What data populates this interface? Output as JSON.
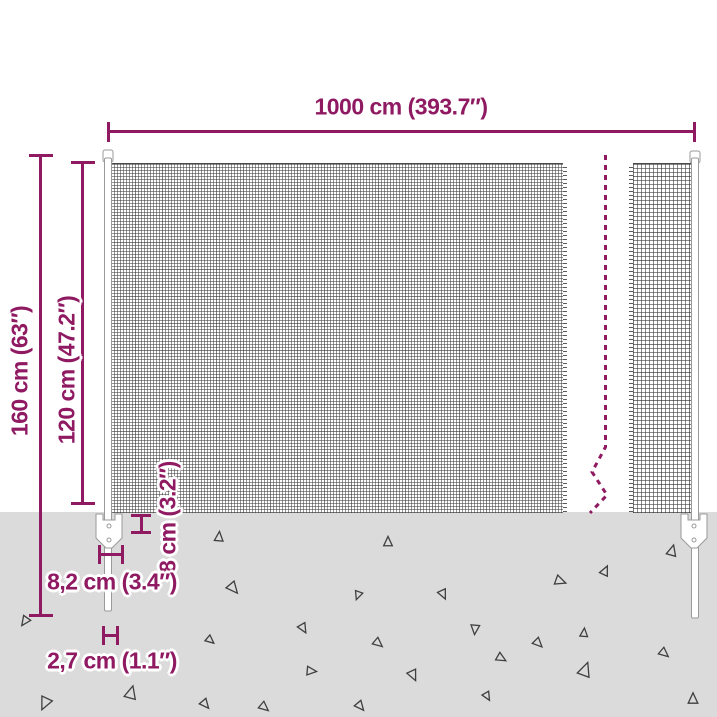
{
  "diagram": {
    "description": "wire-mesh-fence-dimension-diagram",
    "accent_color": "#8f1a62",
    "ground_color": "#dbdbdb",
    "mesh_wire_color": "#3e3e3e",
    "post_fill": "#ffffff",
    "post_outline": "#9a9a9a",
    "triangle_outline": "#3f3f3f",
    "labels": {
      "total_width": "1000 cm (393.7″)",
      "total_height": "160 cm (63″)",
      "fence_height": "120 cm (47.2″)",
      "anchor_plate_height": "8 cm (3.2″)",
      "anchor_plate_width": "8,2 cm (3.4″)",
      "spike_width": "2,7 cm (1.1″)"
    },
    "ground_triangles": [
      {
        "x": 219,
        "y": 537,
        "s": 9,
        "r": 5
      },
      {
        "x": 388,
        "y": 542,
        "s": 9,
        "r": 0
      },
      {
        "x": 672,
        "y": 551,
        "s": 10,
        "r": 15
      },
      {
        "x": 605,
        "y": 571,
        "s": 9,
        "r": 25
      },
      {
        "x": 560,
        "y": 581,
        "s": 10,
        "r": 110
      },
      {
        "x": 233,
        "y": 588,
        "s": 11,
        "r": 140
      },
      {
        "x": 443,
        "y": 594,
        "s": 9,
        "r": 155
      },
      {
        "x": 303,
        "y": 628,
        "s": 9,
        "r": 150
      },
      {
        "x": 475,
        "y": 629,
        "s": 9,
        "r": 185
      },
      {
        "x": 584,
        "y": 633,
        "s": 8,
        "r": 5
      },
      {
        "x": 210,
        "y": 640,
        "s": 8,
        "r": 130
      },
      {
        "x": 25,
        "y": 621,
        "s": 9,
        "r": 215
      },
      {
        "x": 378,
        "y": 643,
        "s": 9,
        "r": 130
      },
      {
        "x": 538,
        "y": 643,
        "s": 9,
        "r": 135
      },
      {
        "x": 311,
        "y": 671,
        "s": 9,
        "r": 95
      },
      {
        "x": 501,
        "y": 658,
        "s": 9,
        "r": 120
      },
      {
        "x": 664,
        "y": 653,
        "s": 9,
        "r": 130
      },
      {
        "x": 413,
        "y": 675,
        "s": 10,
        "r": 155
      },
      {
        "x": 585,
        "y": 670,
        "s": 13,
        "r": 20
      },
      {
        "x": 131,
        "y": 693,
        "s": 12,
        "r": 15
      },
      {
        "x": 45,
        "y": 703,
        "s": 12,
        "r": 205
      },
      {
        "x": 205,
        "y": 704,
        "s": 9,
        "r": 140
      },
      {
        "x": 264,
        "y": 707,
        "s": 9,
        "r": 130
      },
      {
        "x": 487,
        "y": 696,
        "s": 8,
        "r": 150
      },
      {
        "x": 693,
        "y": 699,
        "s": 10,
        "r": 0
      },
      {
        "x": 360,
        "y": 706,
        "s": 9,
        "r": 140
      },
      {
        "x": 358,
        "y": 595,
        "s": 8,
        "r": 200
      }
    ]
  }
}
